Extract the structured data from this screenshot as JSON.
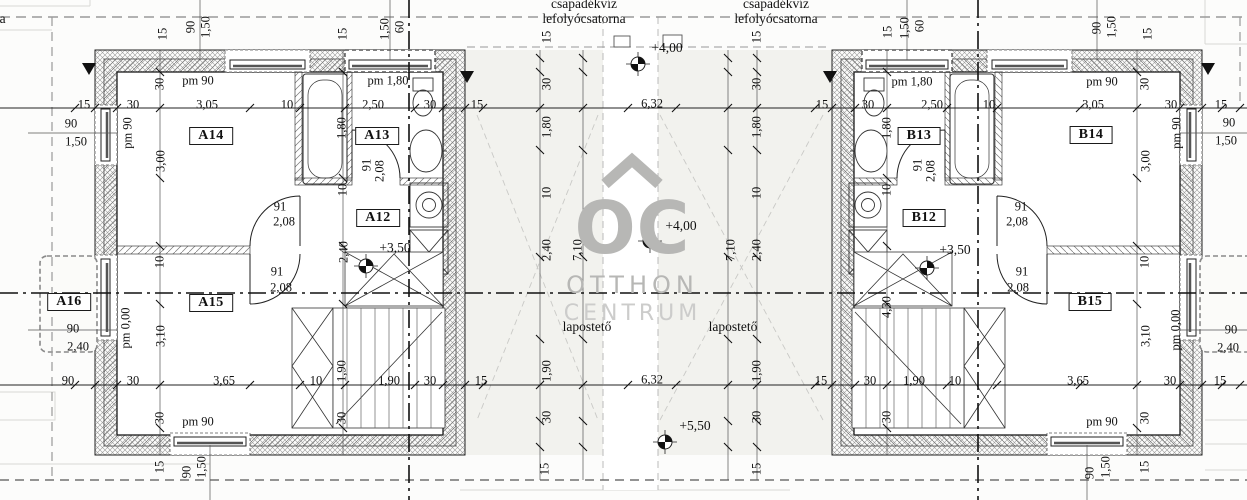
{
  "watermark": {
    "monogram": "OC",
    "line1": "OTTHON",
    "line2": "CENTRUM",
    "color": "#b7b7b5"
  },
  "annotations": {
    "drain_left": {
      "line1": "csapadékvíz",
      "line2": "lefolyócsatorna"
    },
    "drain_right": {
      "line1": "csapadékvíz",
      "line2": "lefolyócsatorna"
    },
    "drain_edge": {
      "line1": "csapadékvíz",
      "line2": "lefolyócsatorna"
    },
    "flat_roof_left": "lapostető",
    "flat_roof_right": "lapostető"
  },
  "rooms": [
    {
      "id": "A14",
      "x": 211,
      "y": 136
    },
    {
      "id": "A13",
      "x": 377,
      "y": 136
    },
    {
      "id": "A12",
      "x": 378,
      "y": 218
    },
    {
      "id": "A15",
      "x": 211,
      "y": 303
    },
    {
      "id": "A16",
      "x": 69,
      "y": 302
    },
    {
      "id": "B13",
      "x": 919,
      "y": 136
    },
    {
      "id": "B14",
      "x": 1091,
      "y": 135
    },
    {
      "id": "B12",
      "x": 924,
      "y": 218
    },
    {
      "id": "B15",
      "x": 1090,
      "y": 302
    }
  ],
  "elevations": [
    {
      "text": "+4,00",
      "x": 667,
      "y": 48,
      "mx": 638,
      "my": 64
    },
    {
      "text": "+4,00",
      "x": 681,
      "y": 226,
      "mx": 650,
      "my": 241
    },
    {
      "text": "+3,50",
      "x": 395,
      "y": 248,
      "mx": 366,
      "my": 266
    },
    {
      "text": "+3,50",
      "x": 955,
      "y": 250,
      "mx": 927,
      "my": 268
    },
    {
      "text": "+5,50",
      "x": 695,
      "y": 426,
      "mx": 665,
      "my": 442
    }
  ],
  "labels": {
    "horizontal": [
      {
        "t": "15",
        "x": 84,
        "y": 105
      },
      {
        "t": "30",
        "x": 133,
        "y": 105
      },
      {
        "t": "3,05",
        "x": 207,
        "y": 105
      },
      {
        "t": "10",
        "x": 287,
        "y": 105
      },
      {
        "t": "2,50",
        "x": 373,
        "y": 105
      },
      {
        "t": "30",
        "x": 430,
        "y": 105
      },
      {
        "t": "15",
        "x": 477,
        "y": 105
      },
      {
        "t": "6,32",
        "x": 652,
        "y": 104
      },
      {
        "t": "15",
        "x": 822,
        "y": 105
      },
      {
        "t": "30",
        "x": 868,
        "y": 105
      },
      {
        "t": "2,50",
        "x": 932,
        "y": 105
      },
      {
        "t": "10",
        "x": 989,
        "y": 105
      },
      {
        "t": "3,05",
        "x": 1093,
        "y": 105
      },
      {
        "t": "30",
        "x": 1171,
        "y": 105
      },
      {
        "t": "15",
        "x": 1221,
        "y": 105
      },
      {
        "t": "90",
        "x": 68,
        "y": 381
      },
      {
        "t": "30",
        "x": 133,
        "y": 381
      },
      {
        "t": "3,65",
        "x": 224,
        "y": 381
      },
      {
        "t": "10",
        "x": 316,
        "y": 381
      },
      {
        "t": "1,90",
        "x": 389,
        "y": 381
      },
      {
        "t": "30",
        "x": 430,
        "y": 381
      },
      {
        "t": "15",
        "x": 481,
        "y": 381
      },
      {
        "t": "6,32",
        "x": 652,
        "y": 380
      },
      {
        "t": "15",
        "x": 821,
        "y": 381
      },
      {
        "t": "30",
        "x": 870,
        "y": 381
      },
      {
        "t": "1,90",
        "x": 914,
        "y": 381
      },
      {
        "t": "10",
        "x": 955,
        "y": 381
      },
      {
        "t": "3,65",
        "x": 1078,
        "y": 381
      },
      {
        "t": "30",
        "x": 1170,
        "y": 381
      },
      {
        "t": "15",
        "x": 1220,
        "y": 381
      },
      {
        "t": "90",
        "x": 71,
        "y": 124
      },
      {
        "t": "1,50",
        "x": 76,
        "y": 142
      },
      {
        "t": "90",
        "x": 73,
        "y": 329
      },
      {
        "t": "2,40",
        "x": 78,
        "y": 347
      },
      {
        "t": "90",
        "x": 1229,
        "y": 123
      },
      {
        "t": "1,50",
        "x": 1226,
        "y": 141
      },
      {
        "t": "90",
        "x": 1231,
        "y": 330
      },
      {
        "t": "2,40",
        "x": 1228,
        "y": 348
      },
      {
        "t": "91",
        "x": 280,
        "y": 207
      },
      {
        "t": "2,08",
        "x": 284,
        "y": 222
      },
      {
        "t": "91",
        "x": 277,
        "y": 272
      },
      {
        "t": "2,08",
        "x": 281,
        "y": 288
      },
      {
        "t": "91",
        "x": 1021,
        "y": 207
      },
      {
        "t": "2,08",
        "x": 1017,
        "y": 222
      },
      {
        "t": "91",
        "x": 1022,
        "y": 272
      },
      {
        "t": "2,08",
        "x": 1018,
        "y": 288
      },
      {
        "t": "pm 90",
        "x": 198,
        "y": 81
      },
      {
        "t": "pm 1,80",
        "x": 388,
        "y": 81
      },
      {
        "t": "pm 1,80",
        "x": 912,
        "y": 82
      },
      {
        "t": "pm 90",
        "x": 1102,
        "y": 82
      },
      {
        "t": "pm 90",
        "x": 198,
        "y": 422
      },
      {
        "t": "pm 90",
        "x": 1102,
        "y": 422
      }
    ],
    "vertical": [
      {
        "t": "15",
        "x": 163,
        "y": 34
      },
      {
        "t": "90",
        "x": 191,
        "y": 27
      },
      {
        "t": "1,50",
        "x": 206,
        "y": 27
      },
      {
        "t": "15",
        "x": 343,
        "y": 34
      },
      {
        "t": "1,50",
        "x": 385,
        "y": 29
      },
      {
        "t": "60",
        "x": 400,
        "y": 27
      },
      {
        "t": "15",
        "x": 888,
        "y": 32
      },
      {
        "t": "1,50",
        "x": 905,
        "y": 28
      },
      {
        "t": "60",
        "x": 920,
        "y": 26
      },
      {
        "t": "90",
        "x": 1097,
        "y": 28
      },
      {
        "t": "1,50",
        "x": 1112,
        "y": 27
      },
      {
        "t": "15",
        "x": 1148,
        "y": 34
      },
      {
        "t": "30",
        "x": 160,
        "y": 84
      },
      {
        "t": "3,00",
        "x": 161,
        "y": 161
      },
      {
        "t": "10",
        "x": 160,
        "y": 262
      },
      {
        "t": "3,10",
        "x": 161,
        "y": 336
      },
      {
        "t": "30",
        "x": 160,
        "y": 418
      },
      {
        "t": "15",
        "x": 160,
        "y": 467
      },
      {
        "t": "1,80",
        "x": 342,
        "y": 128
      },
      {
        "t": "10",
        "x": 343,
        "y": 190
      },
      {
        "t": "2,40",
        "x": 344,
        "y": 252
      },
      {
        "t": "1,90",
        "x": 342,
        "y": 371
      },
      {
        "t": "30",
        "x": 342,
        "y": 418
      },
      {
        "t": "pm 90",
        "x": 128,
        "y": 133
      },
      {
        "t": "pm 0,00",
        "x": 126,
        "y": 328
      },
      {
        "t": "90",
        "x": 187,
        "y": 472
      },
      {
        "t": "1,50",
        "x": 202,
        "y": 467
      },
      {
        "t": "91",
        "x": 367,
        "y": 165
      },
      {
        "t": "2,08",
        "x": 380,
        "y": 171
      },
      {
        "t": "91",
        "x": 918,
        "y": 165
      },
      {
        "t": "2,08",
        "x": 931,
        "y": 171
      },
      {
        "t": "15",
        "x": 547,
        "y": 37
      },
      {
        "t": "30",
        "x": 547,
        "y": 84
      },
      {
        "t": "1,80",
        "x": 547,
        "y": 127
      },
      {
        "t": "10",
        "x": 547,
        "y": 193
      },
      {
        "t": "2,40",
        "x": 547,
        "y": 250
      },
      {
        "t": "1,90",
        "x": 547,
        "y": 371
      },
      {
        "t": "30",
        "x": 547,
        "y": 417
      },
      {
        "t": "15",
        "x": 545,
        "y": 469
      },
      {
        "t": "7,10",
        "x": 578,
        "y": 250
      },
      {
        "t": "15",
        "x": 757,
        "y": 37
      },
      {
        "t": "30",
        "x": 757,
        "y": 84
      },
      {
        "t": "1,80",
        "x": 757,
        "y": 127
      },
      {
        "t": "10",
        "x": 757,
        "y": 193
      },
      {
        "t": "2,40",
        "x": 757,
        "y": 250
      },
      {
        "t": "1,90",
        "x": 757,
        "y": 371
      },
      {
        "t": "30",
        "x": 757,
        "y": 417
      },
      {
        "t": "15",
        "x": 757,
        "y": 469
      },
      {
        "t": "7,10",
        "x": 731,
        "y": 250
      },
      {
        "t": "1,80",
        "x": 887,
        "y": 128
      },
      {
        "t": "10",
        "x": 887,
        "y": 190
      },
      {
        "t": "4,30",
        "x": 887,
        "y": 307
      },
      {
        "t": "30",
        "x": 887,
        "y": 417
      },
      {
        "t": "30",
        "x": 1145,
        "y": 84
      },
      {
        "t": "3,00",
        "x": 1146,
        "y": 161
      },
      {
        "t": "10",
        "x": 1145,
        "y": 262
      },
      {
        "t": "3,10",
        "x": 1146,
        "y": 336
      },
      {
        "t": "30",
        "x": 1145,
        "y": 418
      },
      {
        "t": "15",
        "x": 1145,
        "y": 467
      },
      {
        "t": "pm 90",
        "x": 1177,
        "y": 133
      },
      {
        "t": "pm 0,00",
        "x": 1176,
        "y": 330
      },
      {
        "t": "90",
        "x": 1090,
        "y": 473
      },
      {
        "t": "1,50",
        "x": 1106,
        "y": 467
      }
    ]
  }
}
